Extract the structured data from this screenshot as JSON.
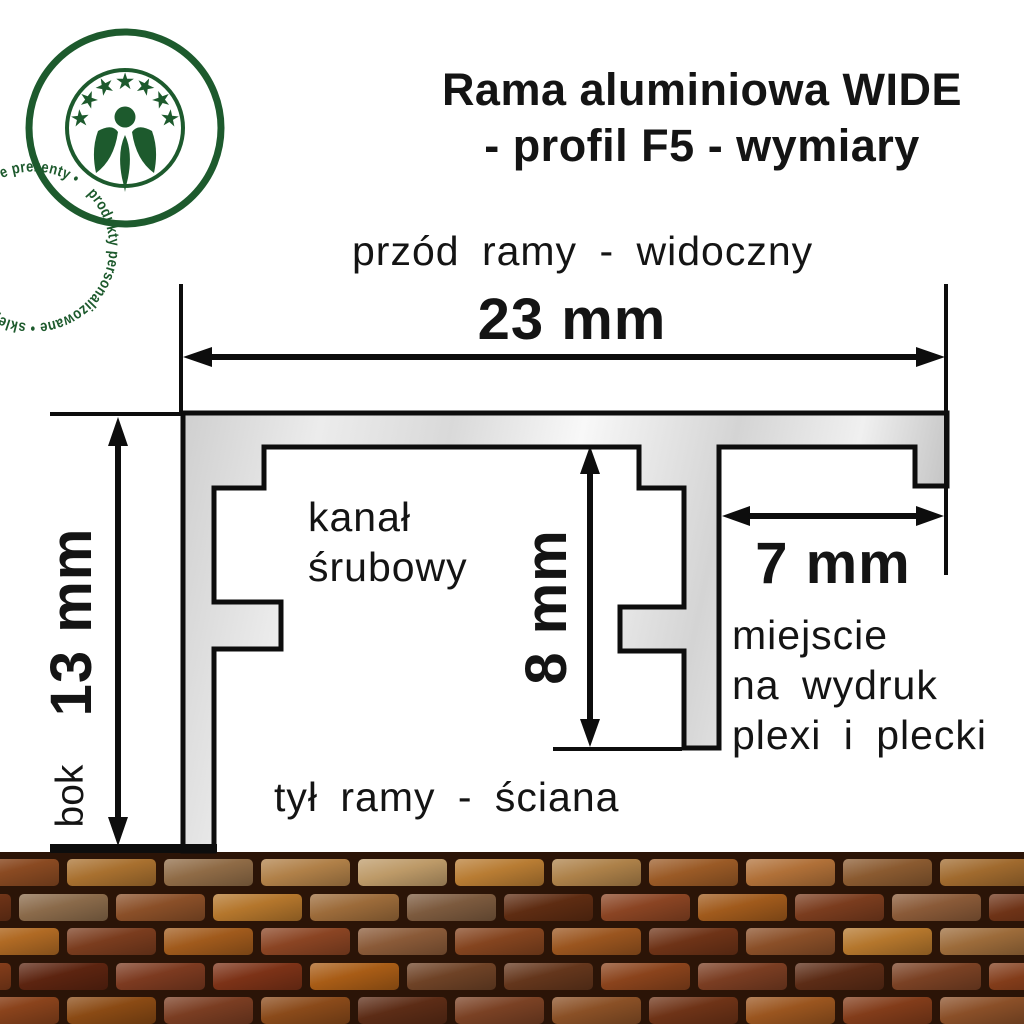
{
  "logo": {
    "ring_text": "produkty personalizowane • sklepzpomyslem.pl • wyjątkowe prezenty •",
    "color": "#1d5a2d"
  },
  "title": {
    "line1": "Rama aluminiowa WIDE",
    "line2": "- profil F5 - wymiary"
  },
  "labels": {
    "front": "przód ramy - widoczny",
    "back": "tył ramy - ściana",
    "side": "bok",
    "screw_channel_line1": "kanał",
    "screw_channel_line2": "śrubowy",
    "print_area_line1": "miejscie",
    "print_area_line2": "na wydruk",
    "print_area_line3": "plexi i plecki"
  },
  "dimensions": {
    "frame_width": "23 mm",
    "frame_height": "13 mm",
    "inner_depth": "8 mm",
    "print_slot": "7 mm"
  },
  "colors": {
    "outline": "#0d0d0d",
    "profile_light": "#f7f7f7",
    "profile_dark": "#c9c9c9",
    "text": "#141414"
  },
  "wall": {
    "mortar": "#2b1407",
    "rows": [
      {
        "offset": -30,
        "colors": [
          "#8a4a22",
          "#a8702f",
          "#8f6b46",
          "#b08048",
          "#bd9a68",
          "#b87c33",
          "#ad8149",
          "#9a5a26",
          "#b07038",
          "#8a5a30",
          "#a06a2e",
          "#8a4a22"
        ]
      },
      {
        "offset": -78,
        "colors": [
          "#6e3317",
          "#8a6a4a",
          "#8a4f28",
          "#b4762c",
          "#9c6b3a",
          "#7c5a3e",
          "#5e2c12",
          "#8a4423",
          "#a05a1c",
          "#7a3c1e",
          "#8a5a38",
          "#6e3317"
        ]
      },
      {
        "offset": -30,
        "colors": [
          "#b06a24",
          "#7a3c1e",
          "#a05a1c",
          "#8a4423",
          "#8a5a38",
          "#84441f",
          "#9a551f",
          "#6e3317",
          "#8a4f28",
          "#b4762c",
          "#9c6b3a",
          "#8a4a22"
        ]
      },
      {
        "offset": -78,
        "colors": [
          "#823c1a",
          "#5c2410",
          "#7c3a20",
          "#7c3217",
          "#a85c16",
          "#6e4226",
          "#64361c",
          "#8a431c",
          "#7a3d22",
          "#5c2c16",
          "#7a4124",
          "#823c1a"
        ]
      },
      {
        "offset": -30,
        "colors": [
          "#8a431c",
          "#8a4a14",
          "#7a3d22",
          "#8a4a1a",
          "#5c2c16",
          "#7a4124",
          "#8a5026",
          "#6e3317",
          "#9a551f",
          "#823c1a",
          "#8a4f28",
          "#8a431c"
        ]
      }
    ]
  }
}
